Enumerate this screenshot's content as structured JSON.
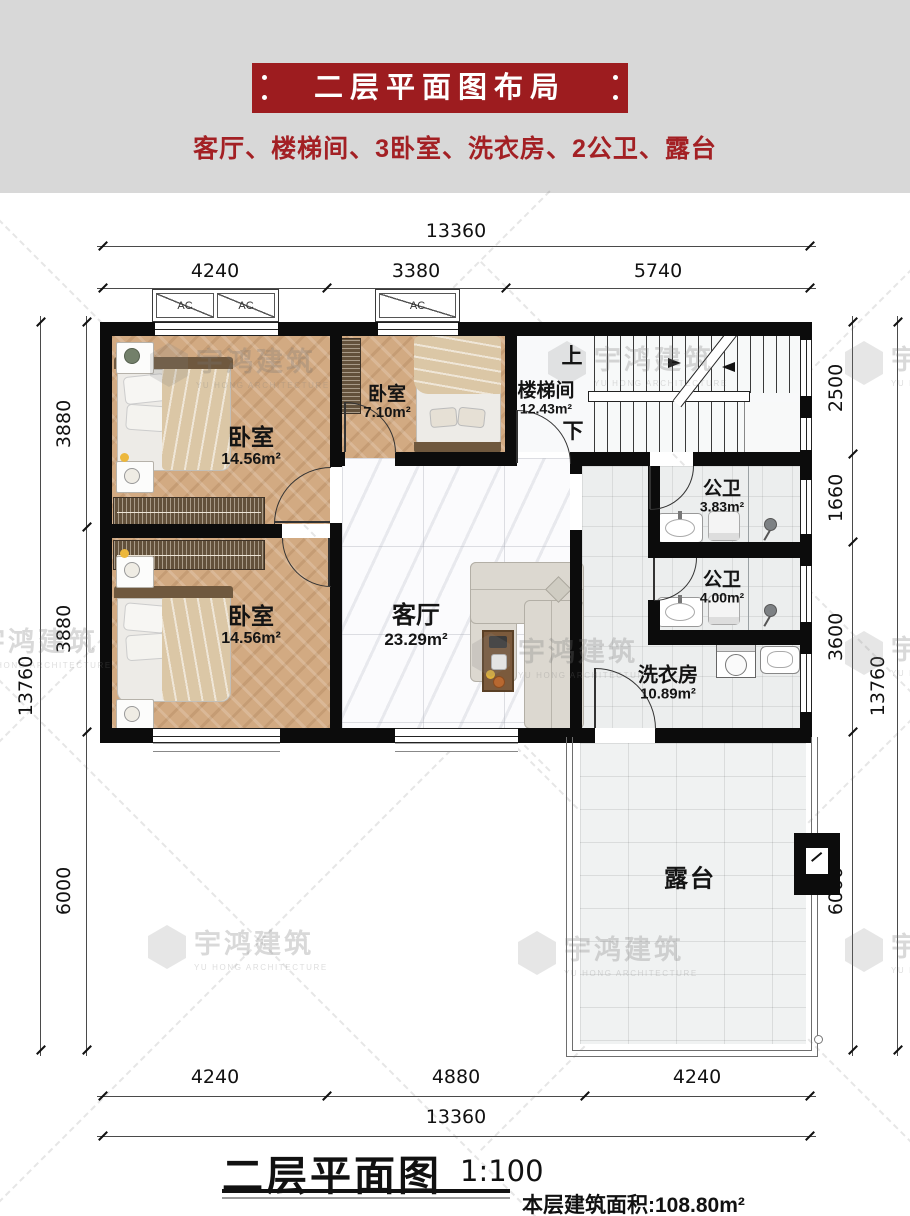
{
  "header": {
    "title": "二层平面图布局",
    "subtitle": "客厅、楼梯间、3卧室、洗衣房、2公卫、露台"
  },
  "watermark": {
    "cn": "宇鸿建筑",
    "en": "YU HONG ARCHITECTURE"
  },
  "plan": {
    "ac_label": "AC",
    "rooms": {
      "bedroom_tl": {
        "name": "卧室",
        "area": "14.56m²"
      },
      "bedroom_tm": {
        "name": "卧室",
        "area": "7.10m²"
      },
      "stairwell": {
        "name": "楼梯间",
        "area": "12.43m²",
        "up": "上",
        "down": "下"
      },
      "bath_upper": {
        "name": "公卫",
        "area": "3.83m²"
      },
      "bath_lower": {
        "name": "公卫",
        "area": "4.00m²"
      },
      "living": {
        "name": "客厅",
        "area": "23.29m²"
      },
      "laundry": {
        "name": "洗衣房",
        "area": "10.89m²"
      },
      "bedroom_bl": {
        "name": "卧室",
        "area": "14.56m²"
      },
      "terrace": {
        "name": "露台"
      }
    },
    "dims": {
      "top_total": "13360",
      "top_segments": [
        "4240",
        "3380",
        "5740"
      ],
      "bottom_segments": [
        "4240",
        "4880",
        "4240"
      ],
      "bottom_total": "13360",
      "left_segments": [
        "3880",
        "3880",
        "6000"
      ],
      "left_total": "13760",
      "right_segments": [
        "2500",
        "1660",
        "3600",
        "6000"
      ],
      "right_total": "13760"
    }
  },
  "footer": {
    "title": "二层平面图",
    "scale": "1:100",
    "area_text": "本层建筑面积:108.80m²"
  },
  "colors": {
    "banner_red": "#9d1c1f",
    "subtitle_red": "#a32024",
    "wall_black": "#0c0c0c",
    "wood_floor": "#d2aa82",
    "header_gray": "#d8d8d8"
  }
}
